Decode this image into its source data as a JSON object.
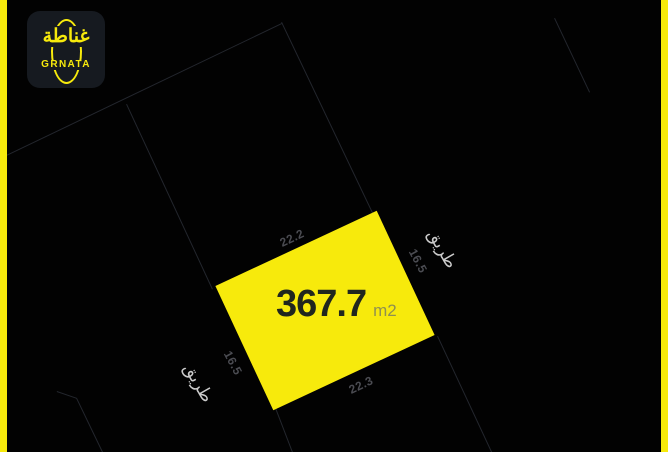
{
  "logo": {
    "arabic": "غناطة",
    "latin": "GRNATA"
  },
  "plot": {
    "area_value": "367.7",
    "area_unit": "m2",
    "dimensions": {
      "top": "22.2",
      "right": "16.5",
      "bottom": "22.3",
      "left": "16.5"
    },
    "road_left": "طريق",
    "road_right": "طريق"
  },
  "colors": {
    "yellow": "#F7EA0C",
    "bg": "#020202",
    "card": "#161A20",
    "areatext": "#20261E",
    "unittext": "#8F9050",
    "dimtext": "#4B4C52",
    "roadtext": "#CBCBCB",
    "line": "#23262D"
  }
}
